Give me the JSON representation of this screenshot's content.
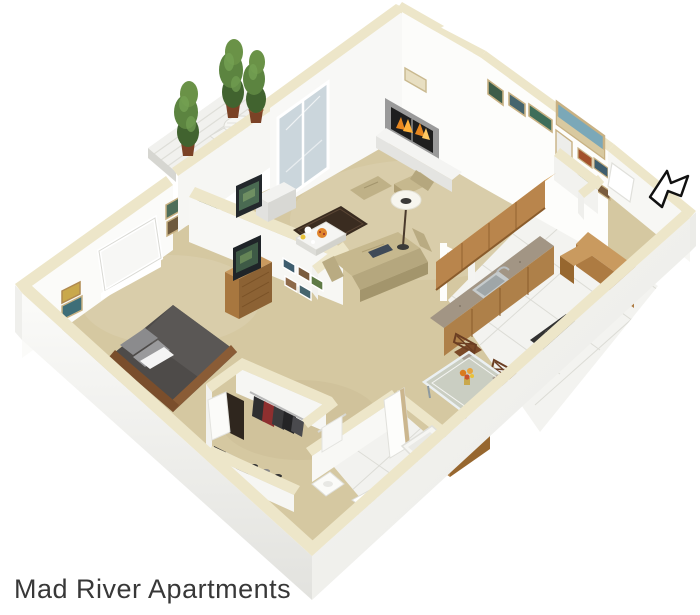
{
  "caption": {
    "text": "Mad River Apartments"
  },
  "palette": {
    "background": "#FFFFFF",
    "carpet_tan": "#D5C8A1",
    "tile_white": "#F3F3F0",
    "wall_white": "#FAFAF8",
    "wall_shade": "#E3E3E0",
    "wall_cap_cream": "#EDE6C9",
    "wood_cabinet": "#B9854C",
    "wood_dark": "#8C6234",
    "counter_granite": "#A29584",
    "sofa_tan": "#C6B88E",
    "rug_brown": "#3A2C20",
    "bed_gray": "#4E4B49",
    "tree_green": "#5C8440",
    "flame_orange": "#E8871F",
    "glass_blue": "#C9D6DC",
    "arrow_black": "#111111",
    "caption_text": "#383838"
  },
  "floor_plan": {
    "type": "3d-isometric-floor-plan",
    "rooms": [
      {
        "name": "living-room"
      },
      {
        "name": "kitchen"
      },
      {
        "name": "dining-area"
      },
      {
        "name": "bedroom"
      },
      {
        "name": "walk-in-closet"
      },
      {
        "name": "bathroom"
      },
      {
        "name": "entry"
      },
      {
        "name": "balcony-patio"
      }
    ],
    "features": [
      "fireplace-with-flames",
      "wall-art-frames",
      "sliding-glass-door",
      "bedroom-window",
      "topiary-trees",
      "patio-table-set",
      "sofa-with-laptop",
      "armchair-and-ottoman",
      "floor-lamp",
      "coffee-table-with-food",
      "area-rug",
      "tv-console",
      "dresser-with-tv",
      "queen-bed",
      "hanging-clothes",
      "kitchen-sink",
      "range-cooktop",
      "breakfast-bar",
      "glass-dining-table",
      "dining-chairs",
      "toilet",
      "bathtub",
      "towel-bar",
      "entry-direction-arrow"
    ]
  }
}
